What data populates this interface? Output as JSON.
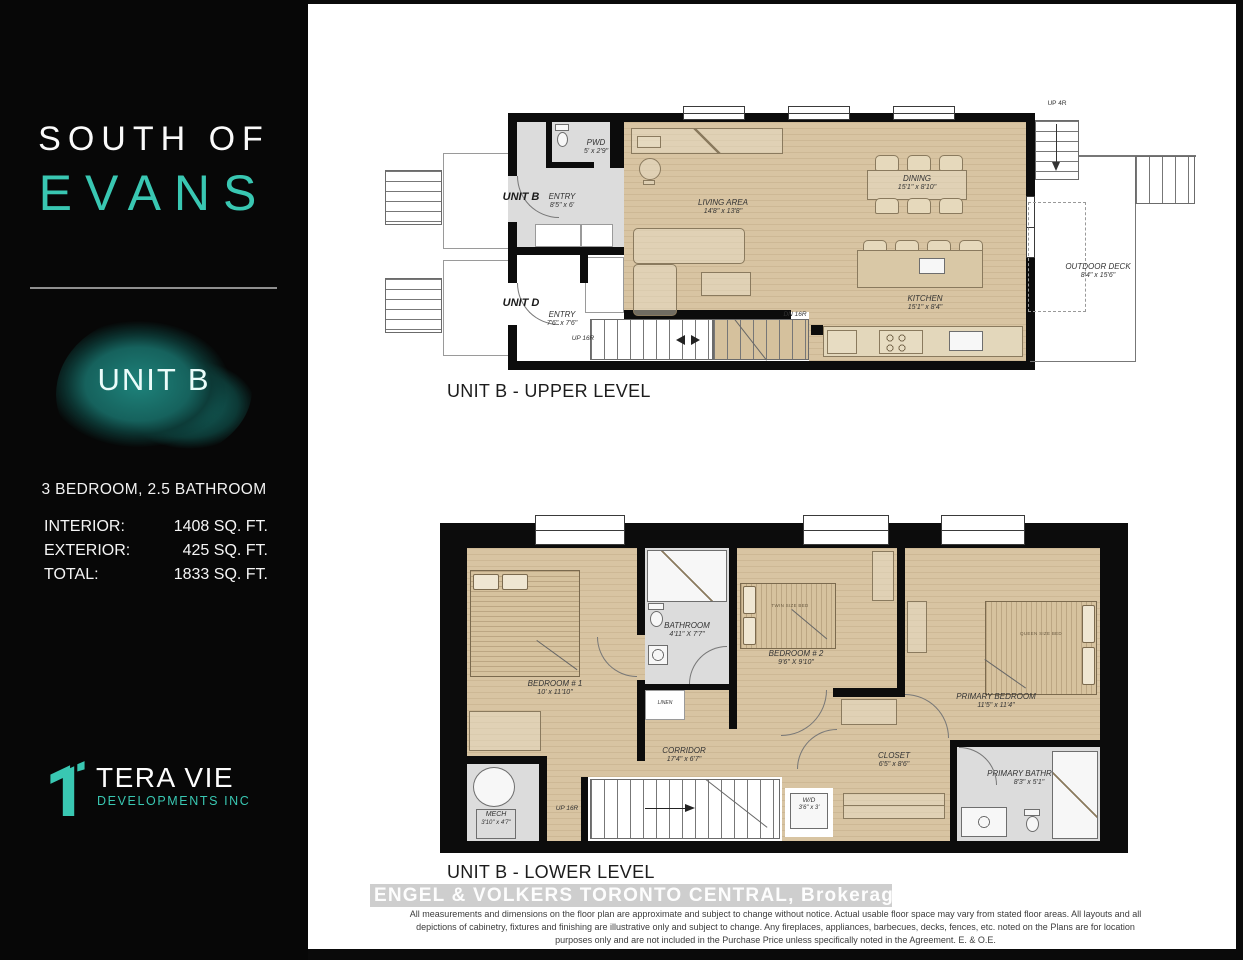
{
  "sidebar": {
    "brand_line1": "SOUTH OF",
    "brand_line2": "EVANS",
    "unit_name": "UNIT B",
    "config": "3 BEDROOM, 2.5 BATHROOM",
    "stats": [
      {
        "label": "INTERIOR:",
        "value": "1408 SQ. FT."
      },
      {
        "label": "EXTERIOR:",
        "value": "425 SQ. FT."
      },
      {
        "label": "TOTAL:",
        "value": "1833 SQ. FT."
      }
    ],
    "developer": {
      "name": "TERA VIE",
      "subtitle": "DEVELOPMENTS INC"
    }
  },
  "colors": {
    "accent_teal": "#39c7b2",
    "splash_teal": "#16625d",
    "wall_black": "#0c0c0c",
    "wood_floor": "#d8c4a2",
    "gray_floor": "#dcdcdc"
  },
  "upper_plan": {
    "title": "UNIT B - UPPER LEVEL",
    "labels": {
      "unit_b": "UNIT B",
      "unit_d": "UNIT D",
      "pwd": {
        "name": "PWD",
        "dims": "5' x 2'9\""
      },
      "entry_b": {
        "name": "ENTRY",
        "dims": "8'5\" x 6'"
      },
      "entry_d": {
        "name": "ENTRY",
        "dims": "7'6\" x 7'6\""
      },
      "living": {
        "name": "LIVING AREA",
        "dims": "14'8\" x 13'8\""
      },
      "dining": {
        "name": "DINING",
        "dims": "15'1\" x 8'10\""
      },
      "kitchen": {
        "name": "KITCHEN",
        "dims": "15'1\" x 8'4\""
      },
      "deck": {
        "name": "OUTDOOR DECK",
        "dims": "8'4\" x 15'6\""
      },
      "stairs_up": "UP 16R",
      "stairs_dn": "DN 16R",
      "stairs_deck": "UP 4R"
    }
  },
  "lower_plan": {
    "title": "UNIT B - LOWER LEVEL",
    "labels": {
      "bedroom1": {
        "name": "BEDROOM # 1",
        "dims": "10' x 11'10\""
      },
      "bathroom": {
        "name": "BATHROOM",
        "dims": "4'11\" X 7'7\""
      },
      "linen": "LINEN",
      "bedroom2": {
        "name": "BEDROOM # 2",
        "dims": "9'6\" X 9'10\""
      },
      "primary_bedroom": {
        "name": "PRIMARY BEDROOM",
        "dims": "11'5\" x 11'4\""
      },
      "corridor": {
        "name": "CORRIDOR",
        "dims": "17'4\" x 6'7\""
      },
      "closet": {
        "name": "CLOSET",
        "dims": "6'5\" x 8'6\""
      },
      "wd": {
        "name": "W/D",
        "dims": "3'6\" x 3'"
      },
      "primary_bathroom": {
        "name": "PRIMARY BATHROOM",
        "dims": "8'3\" x 5'1\""
      },
      "mech": {
        "name": "MECH",
        "dims": "3'10\" x 4'7\""
      },
      "stairs_up": "UP 16R",
      "bed2_tag": "TWIN SIZE BED",
      "primary_bed_tag": "QUEEN SIZE BED"
    }
  },
  "footer": {
    "brokerage": "ENGEL & VOLKERS TORONTO CENTRAL, Brokerage",
    "disclaimer": "All measurements and dimensions on the floor plan are approximate and subject to change without notice. Actual usable floor space may vary from stated floor areas. All layouts and all depictions of cabinetry, fixtures and finishing are illustrative only and subject to change. Any fireplaces, appliances, barbecues, decks, fences, etc. noted on the Plans are for location purposes only and are not included in the Purchase Price unless specifically noted in the Agreement. E. & O.E."
  }
}
